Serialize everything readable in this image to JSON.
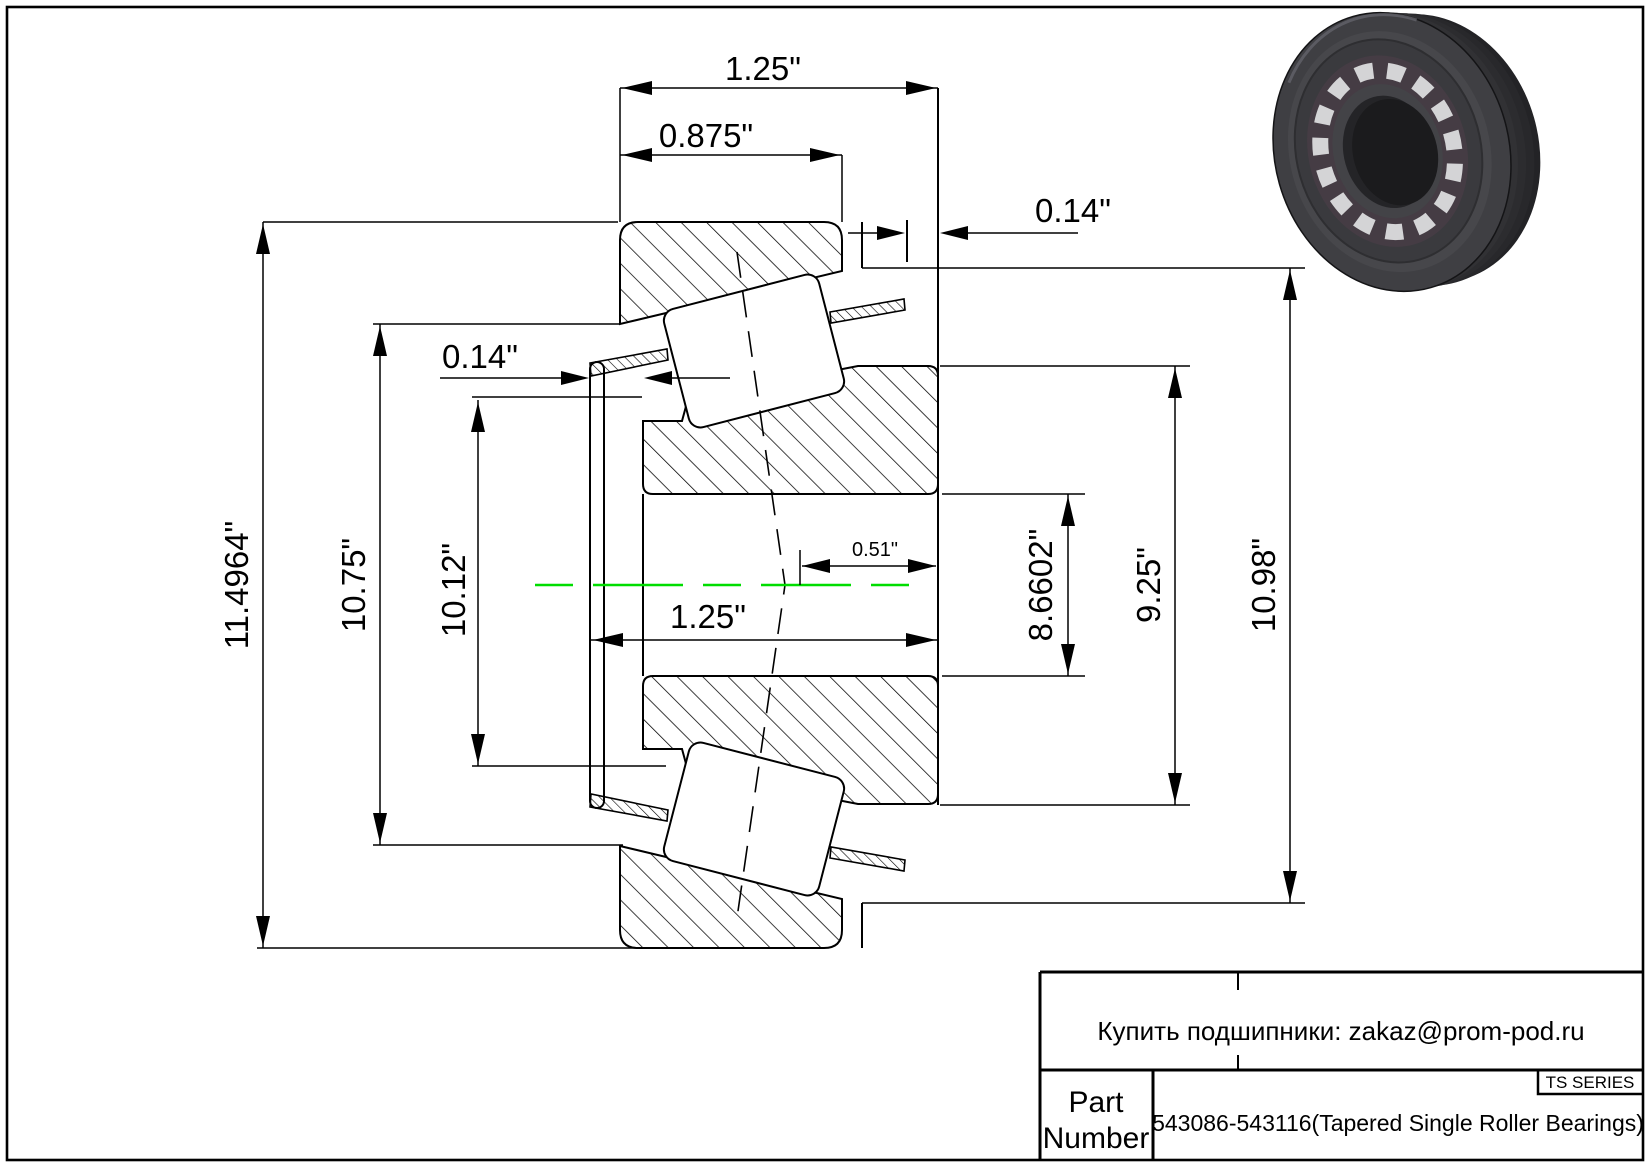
{
  "drawing": {
    "labels": {
      "width_overall": "1.25\"",
      "width_cup": "0.875\"",
      "offset_right": "0.14\"",
      "offset_left": "0.14\"",
      "effective_center": "0.51\"",
      "width_cone": "1.25\"",
      "od_flange": "11.4964\"",
      "od_cup_front": "10.75\"",
      "od_rib": "10.12\"",
      "bore": "8.6602\"",
      "od_cone_back": "9.25\"",
      "od_cup": "10.98\""
    },
    "colors": {
      "centerline": "#00dd00",
      "line": "#000000"
    }
  },
  "title_block": {
    "note": "Купить подшипники: zakaz@prom-pod.ru",
    "series": "TS SERIES",
    "part_label_line1": "Part",
    "part_label_line2": "Number",
    "part_value": "543086-543116(Tapered Single Roller Bearings)"
  }
}
